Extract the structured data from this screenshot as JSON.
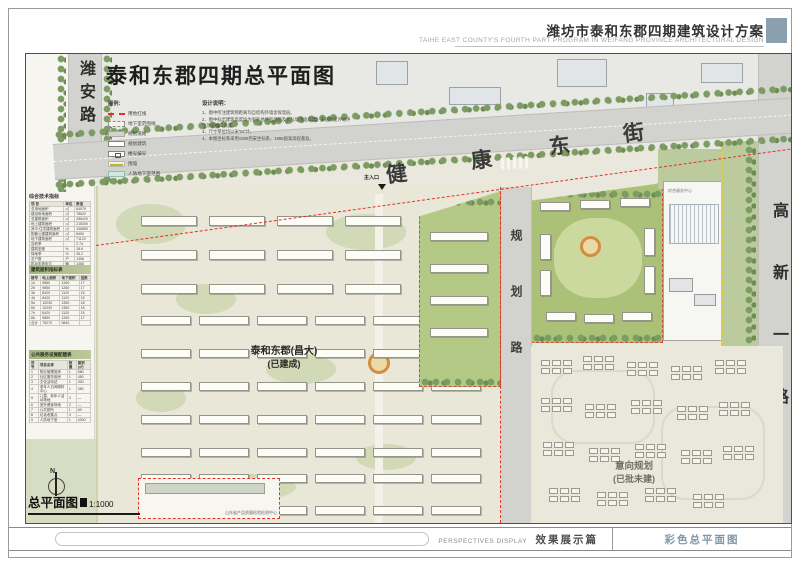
{
  "header": {
    "title_cn": "潍坊市泰和东郡四期建筑设计方案",
    "title_en": "TAIHE EAST COUNTY'S FOURTH PART PROGRAM IN WEIFANG PROVINCE   ARCHITECTURAL  DESIGN"
  },
  "plan": {
    "title": "泰和东郡四期总平面图",
    "scale_name": "总平面图",
    "scale_value": "1:1000",
    "north": "N",
    "built_rows": [
      {
        "x": 115,
        "y": 162,
        "count": 4,
        "w": 56,
        "h": 10,
        "gap": 12
      },
      {
        "x": 115,
        "y": 196,
        "count": 4,
        "w": 56,
        "h": 10,
        "gap": 12
      },
      {
        "x": 115,
        "y": 230,
        "count": 4,
        "w": 56,
        "h": 10,
        "gap": 12
      },
      {
        "x": 115,
        "y": 262,
        "count": 6,
        "w": 50,
        "h": 9,
        "gap": 8
      },
      {
        "x": 115,
        "y": 295,
        "count": 6,
        "w": 50,
        "h": 9,
        "gap": 8
      },
      {
        "x": 115,
        "y": 328,
        "count": 6,
        "w": 50,
        "h": 9,
        "gap": 8
      },
      {
        "x": 115,
        "y": 361,
        "count": 6,
        "w": 50,
        "h": 9,
        "gap": 8
      },
      {
        "x": 115,
        "y": 394,
        "count": 6,
        "w": 50,
        "h": 9,
        "gap": 8
      },
      {
        "x": 115,
        "y": 420,
        "count": 6,
        "w": 50,
        "h": 9,
        "gap": 8
      },
      {
        "x": 115,
        "y": 452,
        "count": 6,
        "w": 50,
        "h": 9,
        "gap": 8
      }
    ],
    "intent_clusters": [
      [
        10,
        14
      ],
      [
        52,
        10
      ],
      [
        96,
        16
      ],
      [
        140,
        20
      ],
      [
        184,
        14
      ],
      [
        10,
        52
      ],
      [
        54,
        58
      ],
      [
        100,
        54
      ],
      [
        146,
        60
      ],
      [
        188,
        56
      ],
      [
        12,
        96
      ],
      [
        58,
        102
      ],
      [
        104,
        98
      ],
      [
        150,
        104
      ],
      [
        192,
        100
      ],
      [
        18,
        142
      ],
      [
        66,
        146
      ],
      [
        114,
        142
      ],
      [
        162,
        148
      ]
    ]
  },
  "legend": {
    "title": "图例：",
    "items": [
      {
        "label": "用地红线",
        "swatch": "red-dash"
      },
      {
        "label": "地下室范围线",
        "swatch": "gray-dash"
      },
      {
        "label": "规划道路",
        "swatch": "road"
      },
      {
        "label": "规划建筑",
        "swatch": "building"
      },
      {
        "label": "楼号编号",
        "swatch": "number"
      },
      {
        "label": "围墙",
        "swatch": "wall"
      },
      {
        "label": "人防地下室范围",
        "swatch": "civil"
      }
    ]
  },
  "notes": {
    "title": "设计说明：",
    "items": [
      "1、图中所注建筑物距离均自结构外墙含保温层。",
      "2、图中标示建筑高度均为室外地坪至顶层及女儿墙顶面高度，多层为室外地坪至顶层檐口高度。",
      "3、尺寸单位均以米\"M\"计。",
      "4、本图坐标系采用1980西安坐标系，1985国家高程基准。"
    ]
  },
  "roads": {
    "west": "潍安路",
    "north_chars": [
      "健",
      "康",
      "东",
      "街"
    ],
    "middle": "规划路",
    "east": "高新一路"
  },
  "labels": {
    "built1": "泰和东郡(昌大)",
    "built2": "(已建成)",
    "intent1": "意向规划",
    "intent2": "(已批未建)",
    "main_entrance": "主入口",
    "test_center": "山东省产品质量检验检测中心",
    "service_center": "综合服务中心"
  },
  "sidebar": {
    "tables": [
      {
        "title": "综合技术指标",
        "columns": [
          "项  目",
          "单位",
          "数值"
        ],
        "rows": [
          [
            "总用地面积",
            "㎡",
            "84575"
          ],
          [
            "建设用地面积",
            "㎡",
            "78620"
          ],
          [
            "总建筑面积",
            "㎡",
            "286420"
          ],
          [
            "地上建筑面积",
            "㎡",
            "215300"
          ],
          [
            "其中:住宅建筑面积",
            "㎡",
            "196850"
          ],
          [
            "配套公建建筑面积",
            "㎡",
            "8450"
          ],
          [
            "地下建筑面积",
            "㎡",
            "71120"
          ],
          [
            "容积率",
            "-",
            "2.74"
          ],
          [
            "建筑密度",
            "%",
            "18.6"
          ],
          [
            "绿地率",
            "%",
            "35.2"
          ],
          [
            "总户数",
            "户",
            "1356"
          ],
          [
            "机动车停车位",
            "辆",
            "1460"
          ]
        ]
      },
      {
        "title": "建筑面积指标表",
        "columns": [
          "楼号",
          "地上面积",
          "地下面积",
          "层数"
        ],
        "rows": [
          [
            "1#",
            "9850",
            "1260",
            "17"
          ],
          [
            "2#",
            "9850",
            "1260",
            "17"
          ],
          [
            "3#",
            "8420",
            "1120",
            "15"
          ],
          [
            "4#",
            "8420",
            "1120",
            "15"
          ],
          [
            "5#",
            "10230",
            "1350",
            "18"
          ],
          [
            "6#",
            "10230",
            "1350",
            "18"
          ],
          [
            "7#",
            "8420",
            "1120",
            "15"
          ],
          [
            "8#",
            "9850",
            "1260",
            "17"
          ],
          [
            "合计",
            "75270",
            "9840",
            ""
          ]
        ]
      },
      {
        "title": "公共服务设施配建表",
        "columns": [
          "序号",
          "项目名称",
          "数量",
          "面积(㎡)"
        ],
        "rows": [
          [
            "1",
            "物业管理用房",
            "1",
            "580"
          ],
          [
            "2",
            "社区服务用房",
            "1",
            "450"
          ],
          [
            "3",
            "文化活动站",
            "1",
            "300"
          ],
          [
            "4",
            "老年人日间照料中心",
            "1",
            "350"
          ],
          [
            "5",
            "儿童、老年人活动场地",
            "3",
            "—"
          ],
          [
            "6",
            "室外健身场地",
            "2",
            "—"
          ],
          [
            "7",
            "公共厕所",
            "1",
            "60"
          ],
          [
            "8",
            "垃圾收集点",
            "4",
            "—"
          ],
          [
            "9",
            "人防地下室",
            "1",
            "4300"
          ]
        ]
      }
    ]
  },
  "footer": {
    "en": "PERSPECTIVES DISPLAY",
    "cn": "效果展示篇",
    "sheet": "彩色总平面图"
  },
  "colors": {
    "accent_blue": "#8aa0ae",
    "red_line": "#e23326",
    "sheet_text": "#7f98a8"
  }
}
